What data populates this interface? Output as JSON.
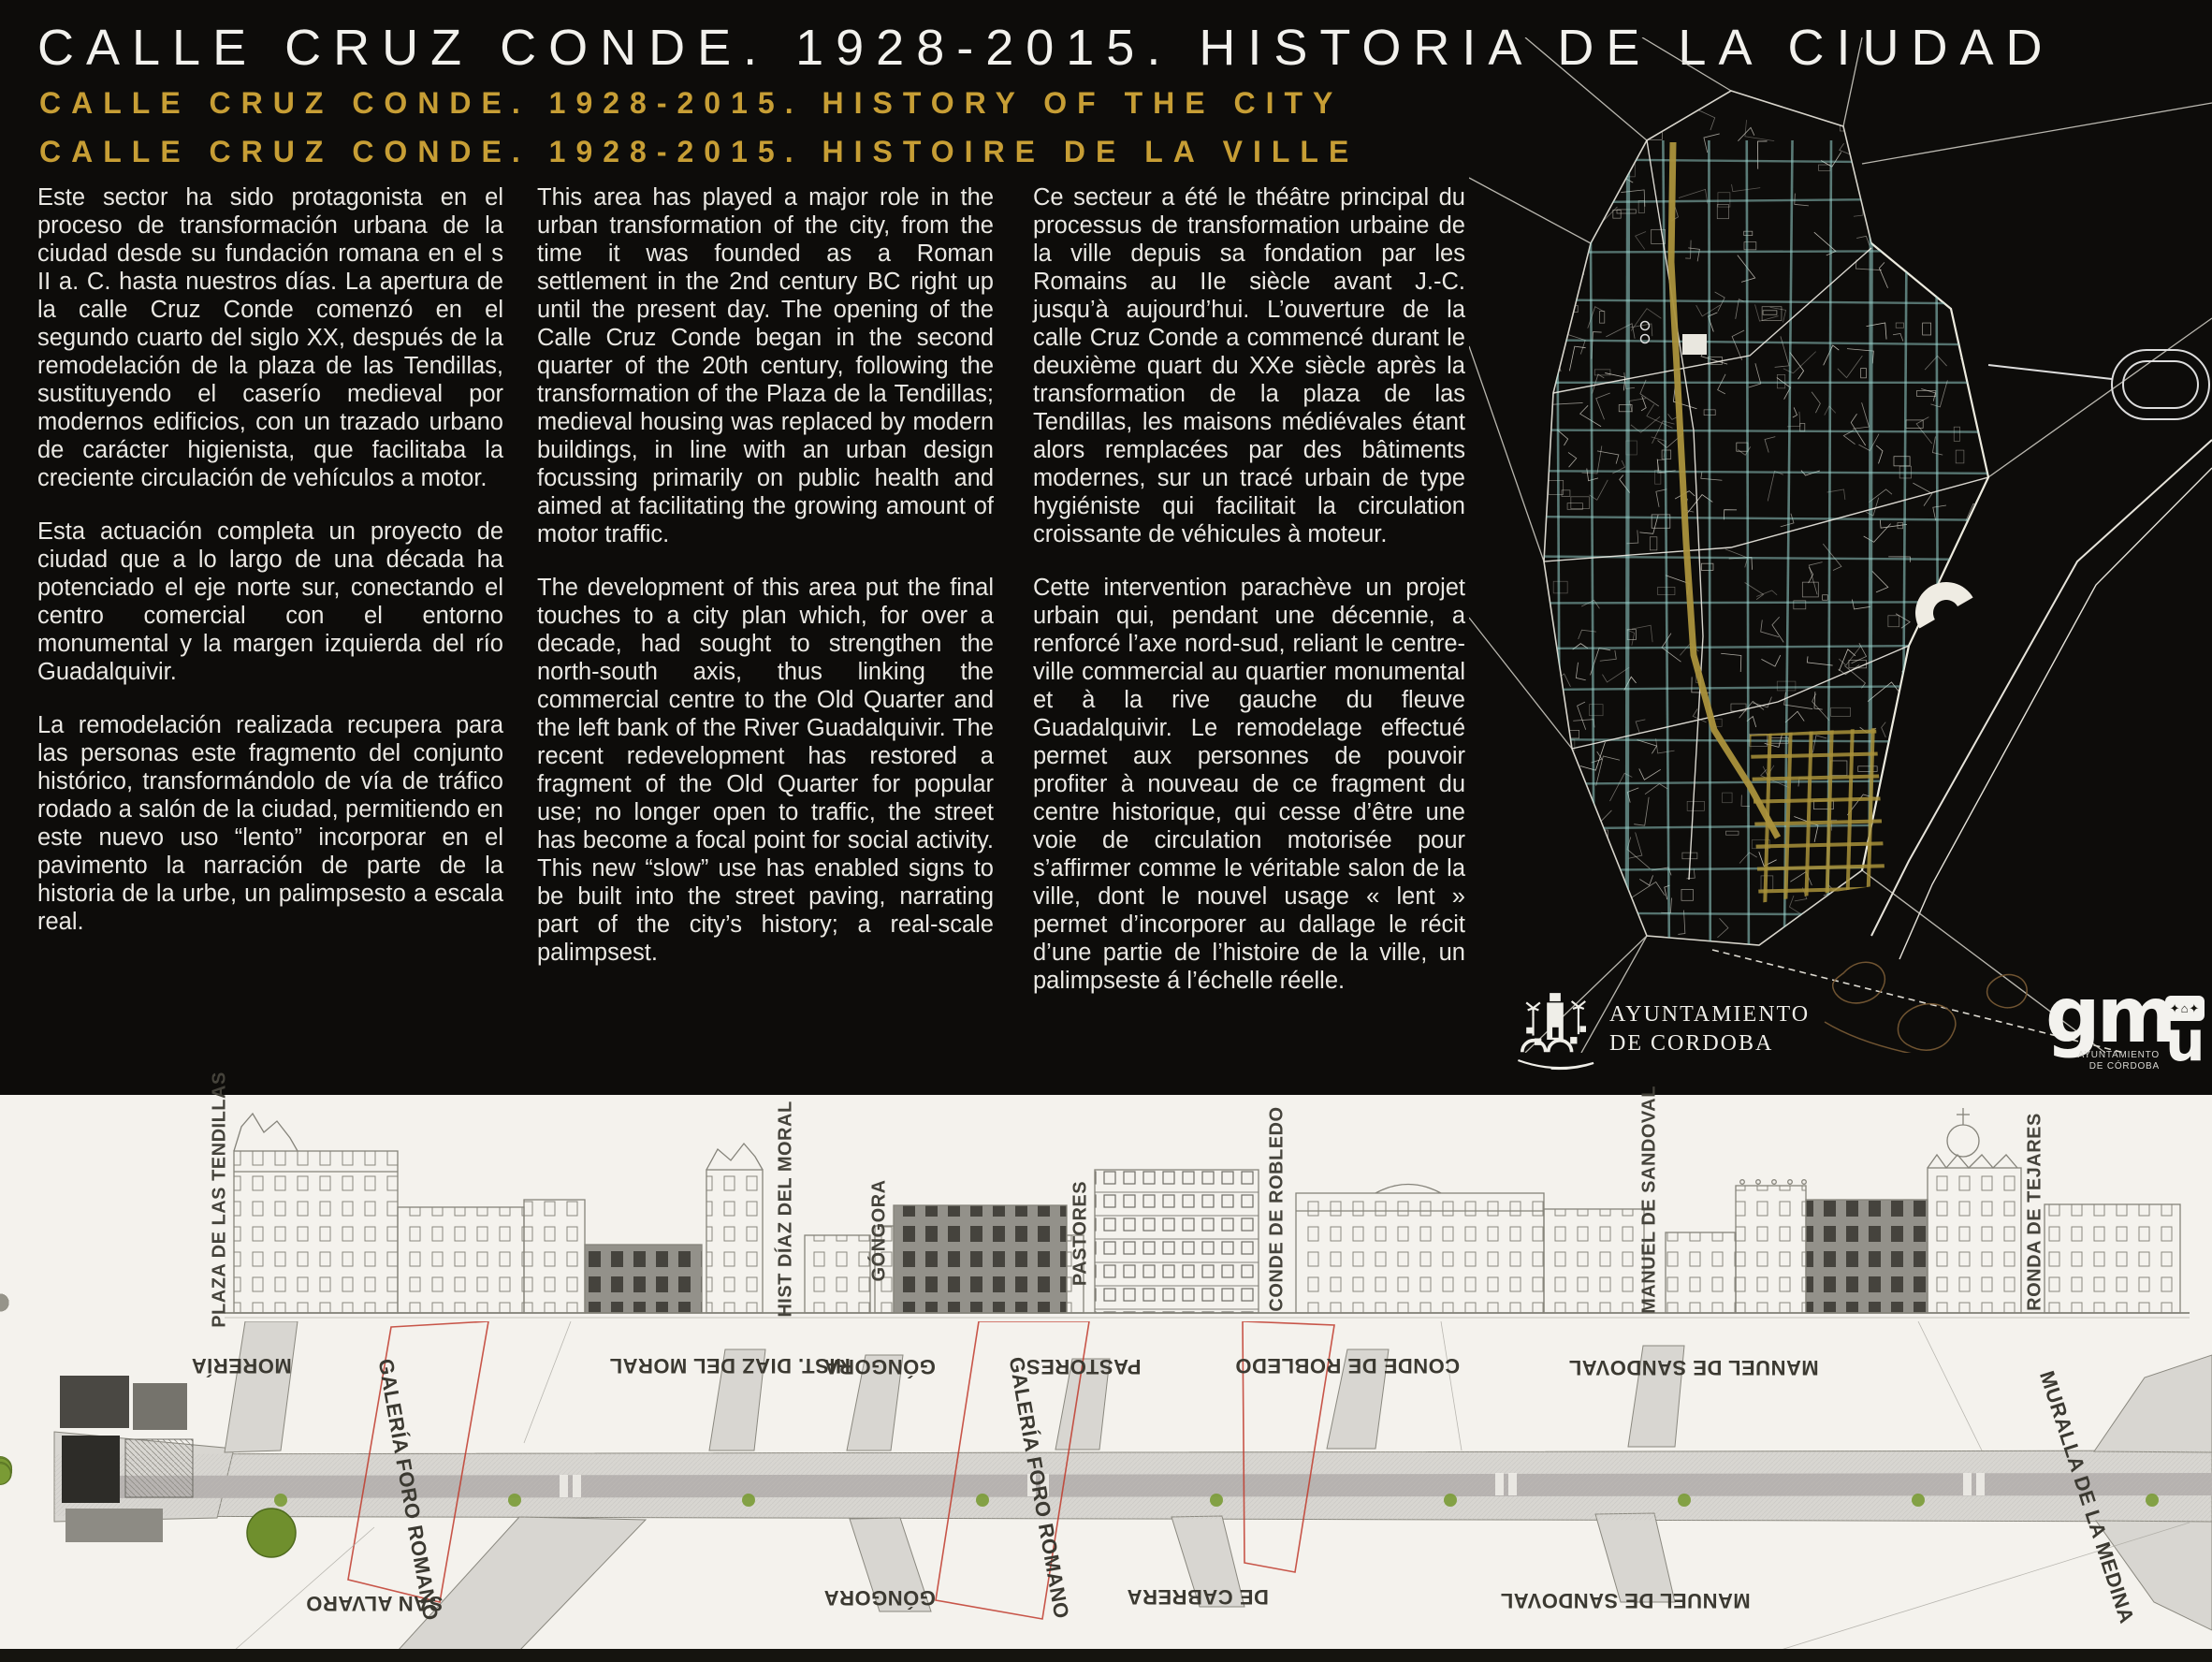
{
  "header": {
    "title_es": "CALLE CRUZ CONDE. 1928-2015. HISTORIA DE LA CIUDAD",
    "title_en": "CALLE CRUZ CONDE. 1928-2015. HISTORY OF THE CITY",
    "title_fr": "CALLE CRUZ CONDE. 1928-2015. HISTOIRE DE LA VILLE"
  },
  "columns": {
    "es": {
      "paragraphs": [
        "Este sector ha sido protagonista en el proceso de transformación urbana de la ciudad desde su fundación romana en el s II a. C. hasta nuestros días. La apertura de la calle Cruz Conde comenzó en el segundo cuarto del siglo XX, después de la remodelación de la plaza de las Tendillas, sustituyendo el caserío medieval por modernos edificios, con un trazado urbano de carácter higienista, que facilitaba la creciente circulación de vehículos a motor.",
        "Esta actuación completa un proyecto de ciudad que a lo largo de una década ha potenciado el eje norte sur, conectando el centro comercial con el entorno monumental y la margen izquierda del río Guadalquivir.",
        "La remodelación realizada recupera para las personas este fragmento del conjunto histórico, transformándolo de vía de tráfico rodado a salón de la ciudad, permitiendo en este nuevo uso “lento” incorporar en el pavimento la narración de parte de la historia de la urbe, un palimpsesto a escala real."
      ]
    },
    "en": {
      "paragraphs": [
        "This area has played a major role in the urban transformation of the city, from the time it was founded as a Roman settlement in the 2nd century BC right up until the present day. The opening of the Calle Cruz Conde began in the second quarter of the 20th century, following the transformation of the Plaza de la Tendillas; medieval housing was replaced by modern buildings, in line with an urban design focussing primarily on public health and aimed at facilitating the growing amount of motor traffic.",
        "The development of this area put the final touches to a city plan which, for over a decade, had sought to strengthen the north-south axis, thus linking the commercial centre to the Old Quarter and the left bank of the River Guadalquivir. The recent redevelopment has restored a fragment of the Old Quarter for popular use; no longer open to traffic, the street has become a focal point for social activity. This new “slow” use has enabled signs to be built into the street paving, narrating part of the city’s history; a real-scale palimpsest."
      ]
    },
    "fr": {
      "paragraphs": [
        "Ce secteur a été le théâtre principal du processus de transformation urbaine de la ville depuis sa fondation par les Romains au IIe siècle avant J.-C. jusqu’à aujourd’hui. L’ouverture de la calle Cruz Conde a commencé durant le deuxième quart du XXe siècle après la transformation de la plaza de las Tendillas, les maisons médiévales étant alors remplacées par des bâtiments modernes, sur un tracé urbain de type hygiéniste qui facilitait la circulation croissante de véhicules à moteur.",
        "Cette intervention parachève un projet urbain qui, pendant une décennie, a renforcé l’axe nord-sud, reliant le centre-ville commercial au quartier monumental et à la rive gauche du fleuve Guadalquivir. Le remodelage effectué permet aux personnes de pouvoir profiter à nouveau de ce fragment du centre historique, qui cesse d’être une voie de circulation motorisée pour s’affirmer comme le véritable salon de la ville, dont le nouvel usage « lent » permet d’incorporer au dallage le récit d’une partie de l’histoire de la ville, un palimpseste á l’échelle réelle."
      ]
    }
  },
  "logos": {
    "ayuntamiento": {
      "line1": "AYUNTAMIENTO",
      "line2": "DE CORDOBA"
    },
    "gmu": {
      "letters": "gm",
      "letter_u": "u",
      "caption_line1": "AYUNTAMIENTO",
      "caption_line2": "DE CÓRDOBA"
    }
  },
  "elevation_labels": {
    "plaza_tendillas": "PLAZA DE LAS TENDILLAS",
    "hist_diaz": "HIST  DÍAZ DEL MORAL",
    "gongora": "GÓNGORA",
    "pastores": "PASTORES",
    "conde_robledo": "CONDE DE ROBLEDO",
    "manuel_sandoval": "MANUEL DE SANDOVAL",
    "ronda_tejares": "RONDA DE TEJARES"
  },
  "plan_labels": {
    "moreria": "MORERÍA",
    "hist_diaz": "HIST. DIAZ DEL MORAL",
    "gongora_top": "GÓNGORA",
    "pastores": "PASTORES",
    "conde_robledo": "CONDE DE ROBLEDO",
    "manuel_sandoval_top": "MANUEL DE SANDOVAL",
    "galeria_foro_1": "GALERÍA FORO ROMANO",
    "galeria_foro_2": "GALERÍA FORO ROMANO",
    "muralla": "MURALLA DE LA MEDINA",
    "san_alvaro": "SAN ALVARO",
    "gongora_bottom": "GÓNGORA",
    "de_cabrera": "DE CABRERA",
    "manuel_sandoval_bottom": "MANUEL DE SANDOVAL"
  },
  "colors": {
    "panel_black": "#0d0c0a",
    "title_white": "#f2f1ed",
    "accent_gold": "#c79e35",
    "map_teal": "#9cd8d2",
    "map_gold": "#a8913a",
    "paper": "#f4f2ed",
    "tree_green": "#7a9b35",
    "zone_red": "#c0392b"
  }
}
